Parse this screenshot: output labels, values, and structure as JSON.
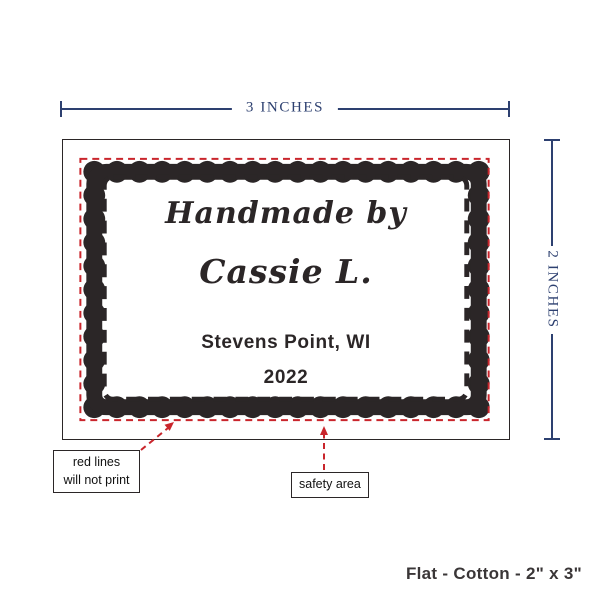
{
  "proof": {
    "dimension_width_label": "3 INCHES",
    "dimension_height_label": "2 INCHES",
    "label": {
      "line1": "Handmade by",
      "line2": "Cassie L.",
      "line3": "Stevens Point, WI",
      "line4": "2022"
    },
    "callouts": {
      "red_lines_line1": "red lines",
      "red_lines_line2": "will not print",
      "safety_area": "safety area"
    },
    "caption": "Flat - Cotton - 2\" x 3\"",
    "colors": {
      "dimension_blue": "#2d4070",
      "print_red": "#c9252c",
      "ink_black": "#2b2627",
      "caption_gray": "#3a3637"
    }
  }
}
